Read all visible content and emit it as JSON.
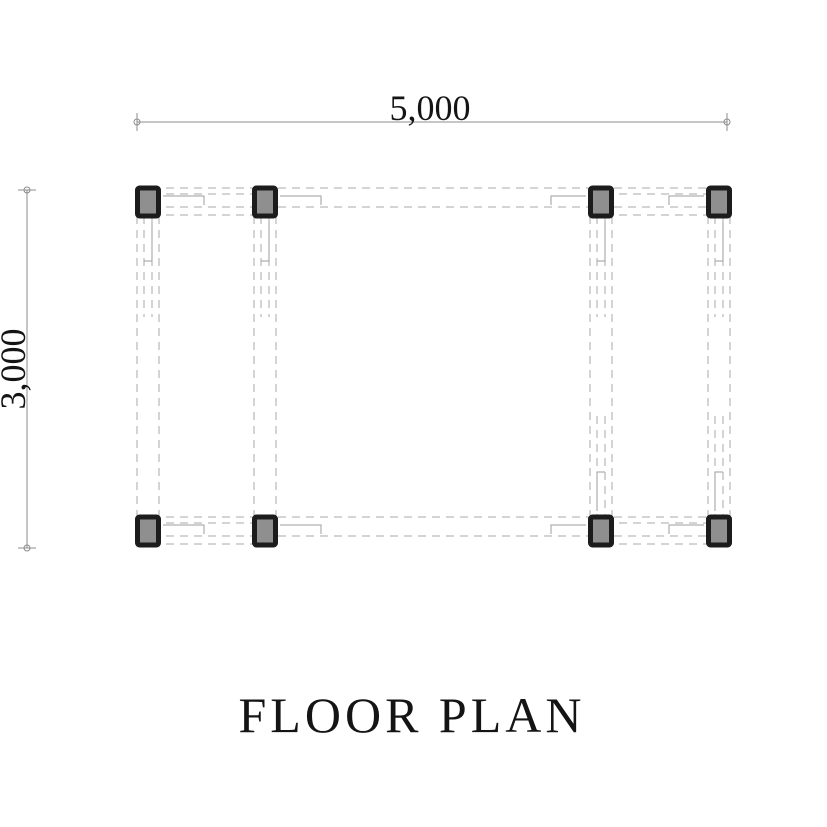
{
  "title": "FLOOR PLAN",
  "dimensions": {
    "width_label": "5,000",
    "height_label": "3,000"
  },
  "colors": {
    "background": "#ffffff",
    "column_border": "#1c1c1c",
    "column_fill": "#8f8f8f",
    "dash_line": "#a8a8a8",
    "step_line": "#9c9c9c",
    "dim_line": "#8c8c8c",
    "text": "#141414"
  },
  "plan": {
    "grid_x": [
      148,
      265,
      601,
      719
    ],
    "grid_y": [
      202,
      531
    ],
    "column_outer_w": 26,
    "column_outer_h": 33,
    "column_stroke": 5,
    "h_through_offsets": [
      -14,
      5
    ],
    "h_short_offsets": [
      -8,
      13
    ],
    "v_through_offsets": [
      -11,
      11
    ],
    "v_inner_offsets": [
      -4,
      4
    ],
    "inner_run": 115,
    "dash_pattern": "8 6"
  },
  "dim_top": {
    "x1": 137,
    "x2": 727,
    "y": 122,
    "label_x": 430,
    "label_y": 120
  },
  "dim_left": {
    "x": 27,
    "y1": 190,
    "y2": 548,
    "label_x": 25,
    "label_y": 369
  },
  "title_pos": {
    "x": 412,
    "y": 732
  }
}
